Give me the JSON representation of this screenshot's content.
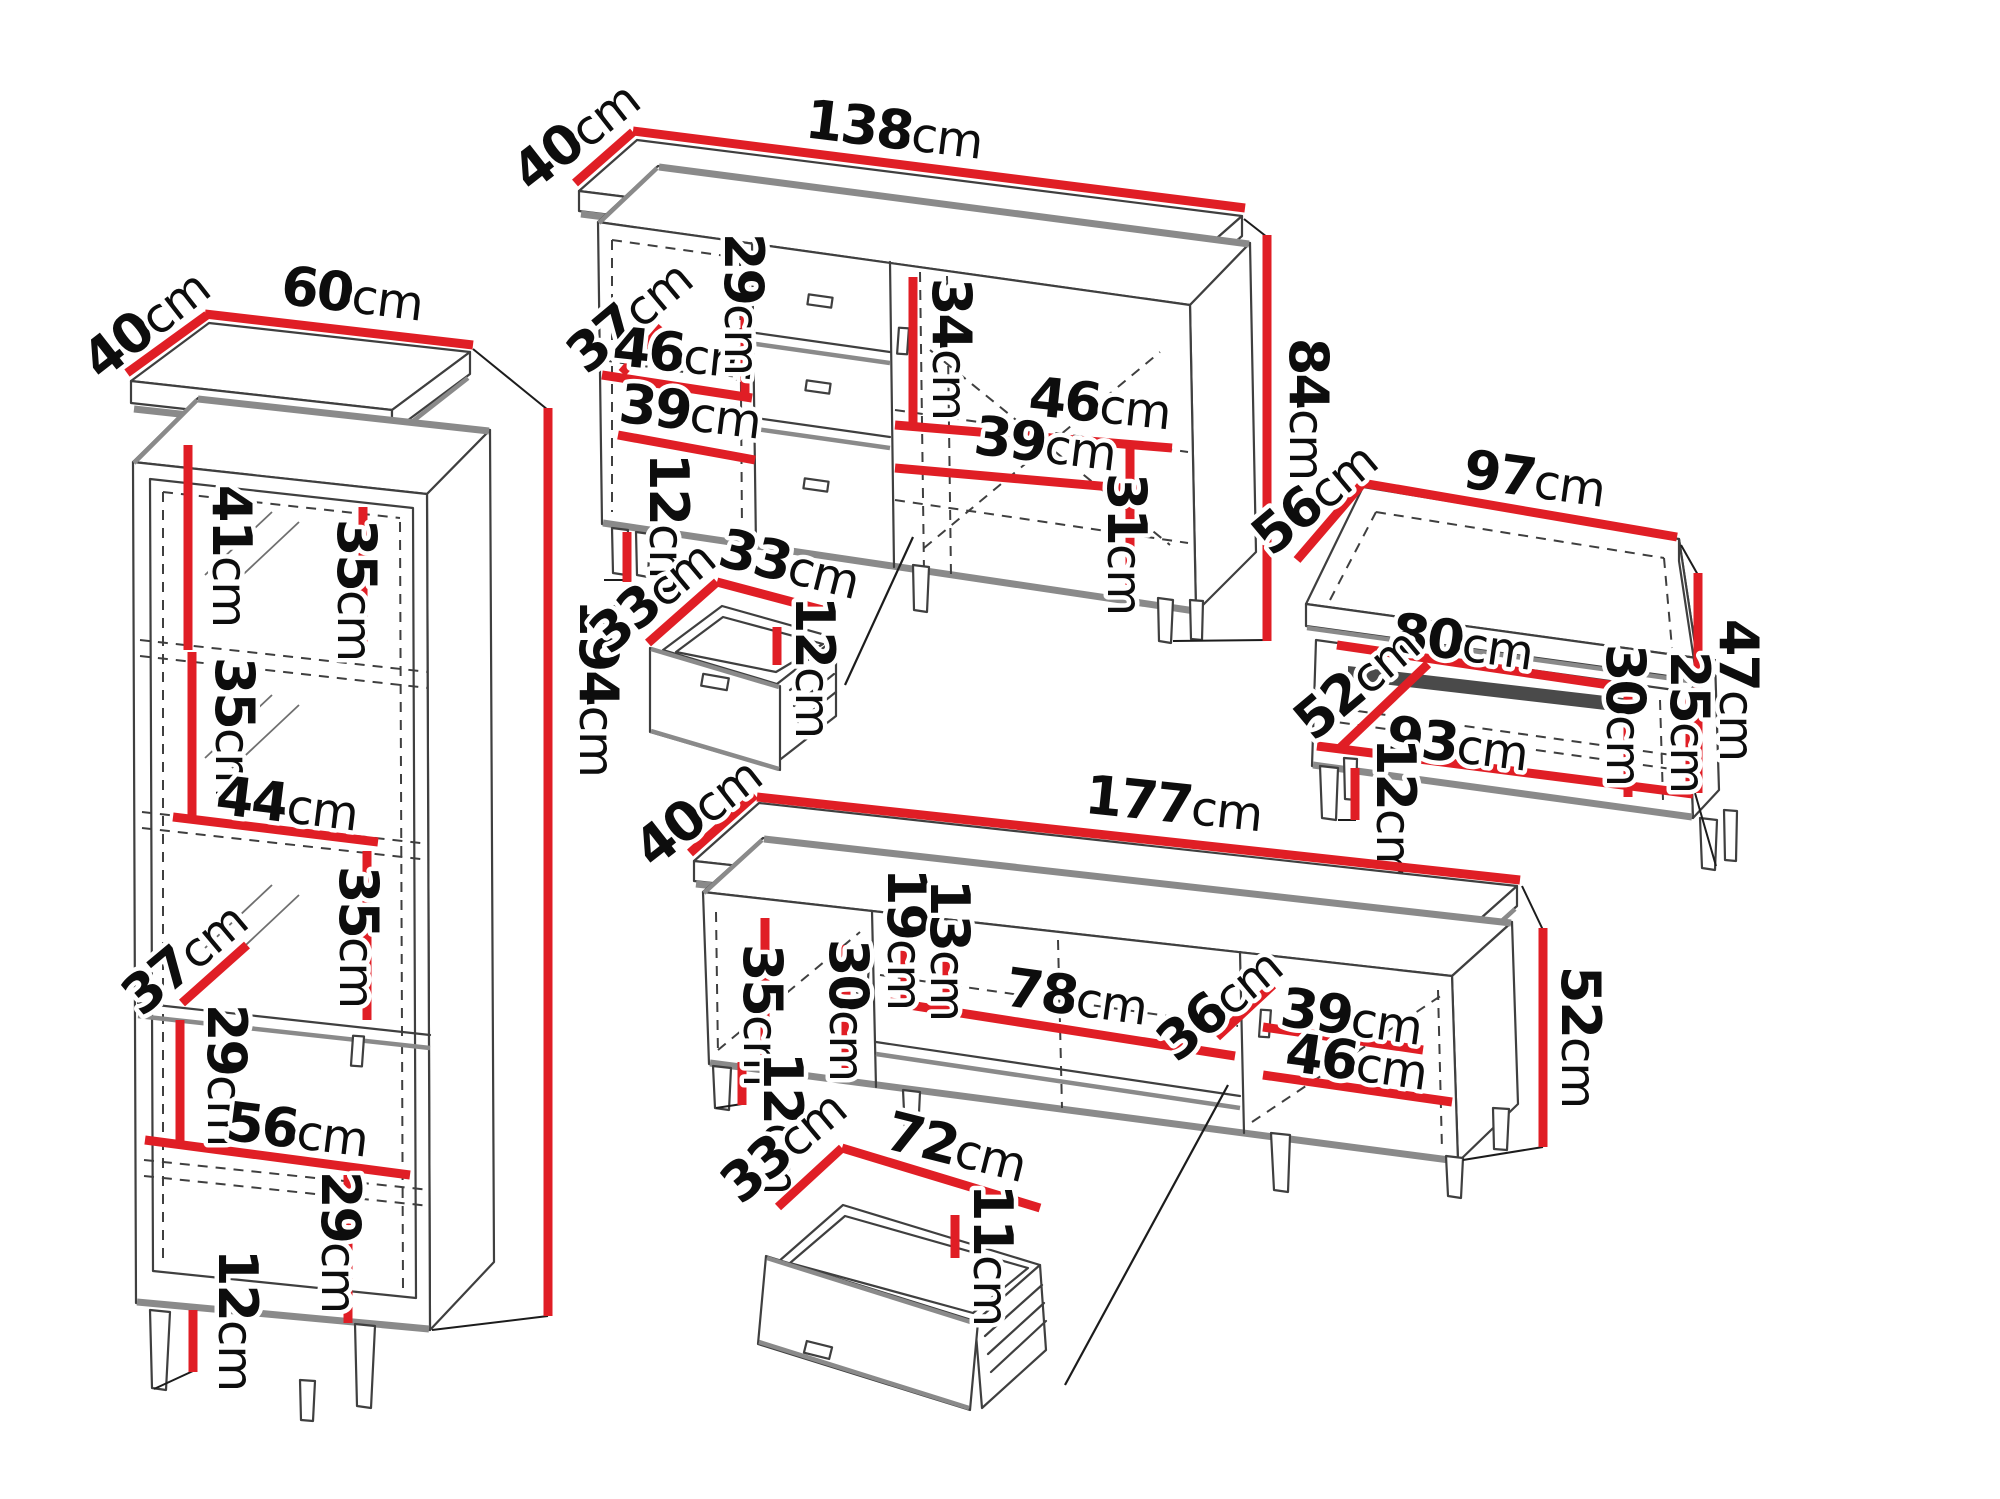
{
  "unit": "cm",
  "colors": {
    "dimension_red": "#e01e25",
    "outline_dark": "#3f3f3f",
    "shadow_gray": "#8a8a8a",
    "background": "#ffffff"
  },
  "pieces": {
    "display_cabinet": {
      "depth": "40",
      "width": "60",
      "height": "194",
      "top_section": "41",
      "shelf_top": "35",
      "shelf_second": "35",
      "interior_width": "44",
      "interior_depth": "37",
      "shelf_third": "35",
      "section_fourth": "29",
      "interior_width_lower": "56",
      "section_bottom": "29",
      "legs": "12"
    },
    "sideboard": {
      "depth": "40",
      "width": "138",
      "height": "84",
      "interior_depth": "37",
      "door_interior_width": "46",
      "interior_top_height": "29",
      "right_top_height": "34",
      "right_interior_width": "46",
      "left_shelf_width": "39",
      "right_shelf_width": "39",
      "bottom_interior_height": "31",
      "legs": "12",
      "drawer": {
        "depth": "33",
        "width": "33",
        "height": "12"
      }
    },
    "coffee_table": {
      "depth": "56",
      "width": "97",
      "height": "47",
      "opening_width": "80",
      "interior_depth": "52",
      "interior_width": "93",
      "interior_height": "30",
      "shelf_space_height": "25",
      "legs": "12"
    },
    "tv_stand": {
      "depth": "40",
      "width": "177",
      "height": "52",
      "door_interior_height": "35",
      "interior_height": "30",
      "niche_height": "19",
      "drawer_front_height": "13",
      "niche_width": "78",
      "interior_depth": "36",
      "right_shelf_width": "39",
      "right_interior_width": "46",
      "legs": "12",
      "drawer": {
        "depth": "33",
        "width": "72",
        "height": "11"
      }
    }
  }
}
